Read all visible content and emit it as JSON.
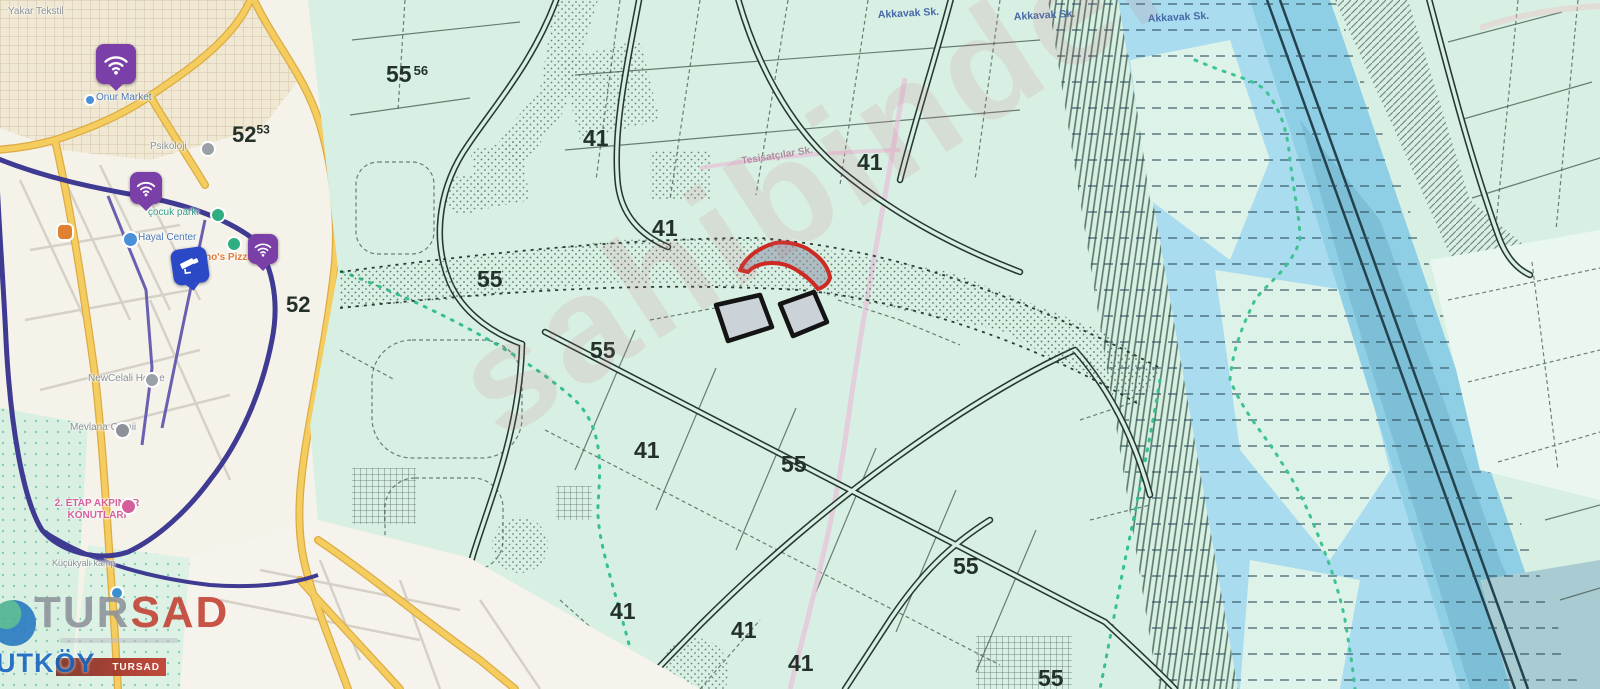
{
  "watermark": {
    "text": "sahibinden"
  },
  "branding": {
    "logo_part1": "TUR",
    "logo_part2": "SAD",
    "banner_label": "TURSAD",
    "district_label": "UTKÖY"
  },
  "street_map": {
    "labels": [
      "Yakar Tekstil",
      "Onur Market",
      "Psikoloji",
      "çocuk parkı",
      "Hayal Center",
      "Domino's Pizza",
      "NewCelali House",
      "Mevlana Camii",
      "2. ETAP AKPINAR\nKONUTLARI",
      "Küçükyalı kamp"
    ]
  },
  "cadastral": {
    "grid_labels": [
      {
        "main": "55",
        "sup": "56"
      },
      {
        "main": "52",
        "sup": "53"
      },
      {
        "main": "52",
        "sup": ""
      },
      {
        "main": "55",
        "sup": ""
      },
      {
        "main": "55",
        "sup": ""
      },
      {
        "main": "41",
        "sup": ""
      },
      {
        "main": "41",
        "sup": ""
      },
      {
        "main": "41",
        "sup": ""
      },
      {
        "main": "41",
        "sup": ""
      },
      {
        "main": "55",
        "sup": ""
      },
      {
        "main": "55",
        "sup": ""
      },
      {
        "main": "41",
        "sup": ""
      },
      {
        "main": "41",
        "sup": ""
      },
      {
        "main": "41",
        "sup": ""
      },
      {
        "main": "55",
        "sup": ""
      }
    ],
    "street_labels": [
      "Akkavak Sk.",
      "Akkavak Sk.",
      "Akkavak Sk.",
      "Tesisatçılar Sk."
    ]
  }
}
